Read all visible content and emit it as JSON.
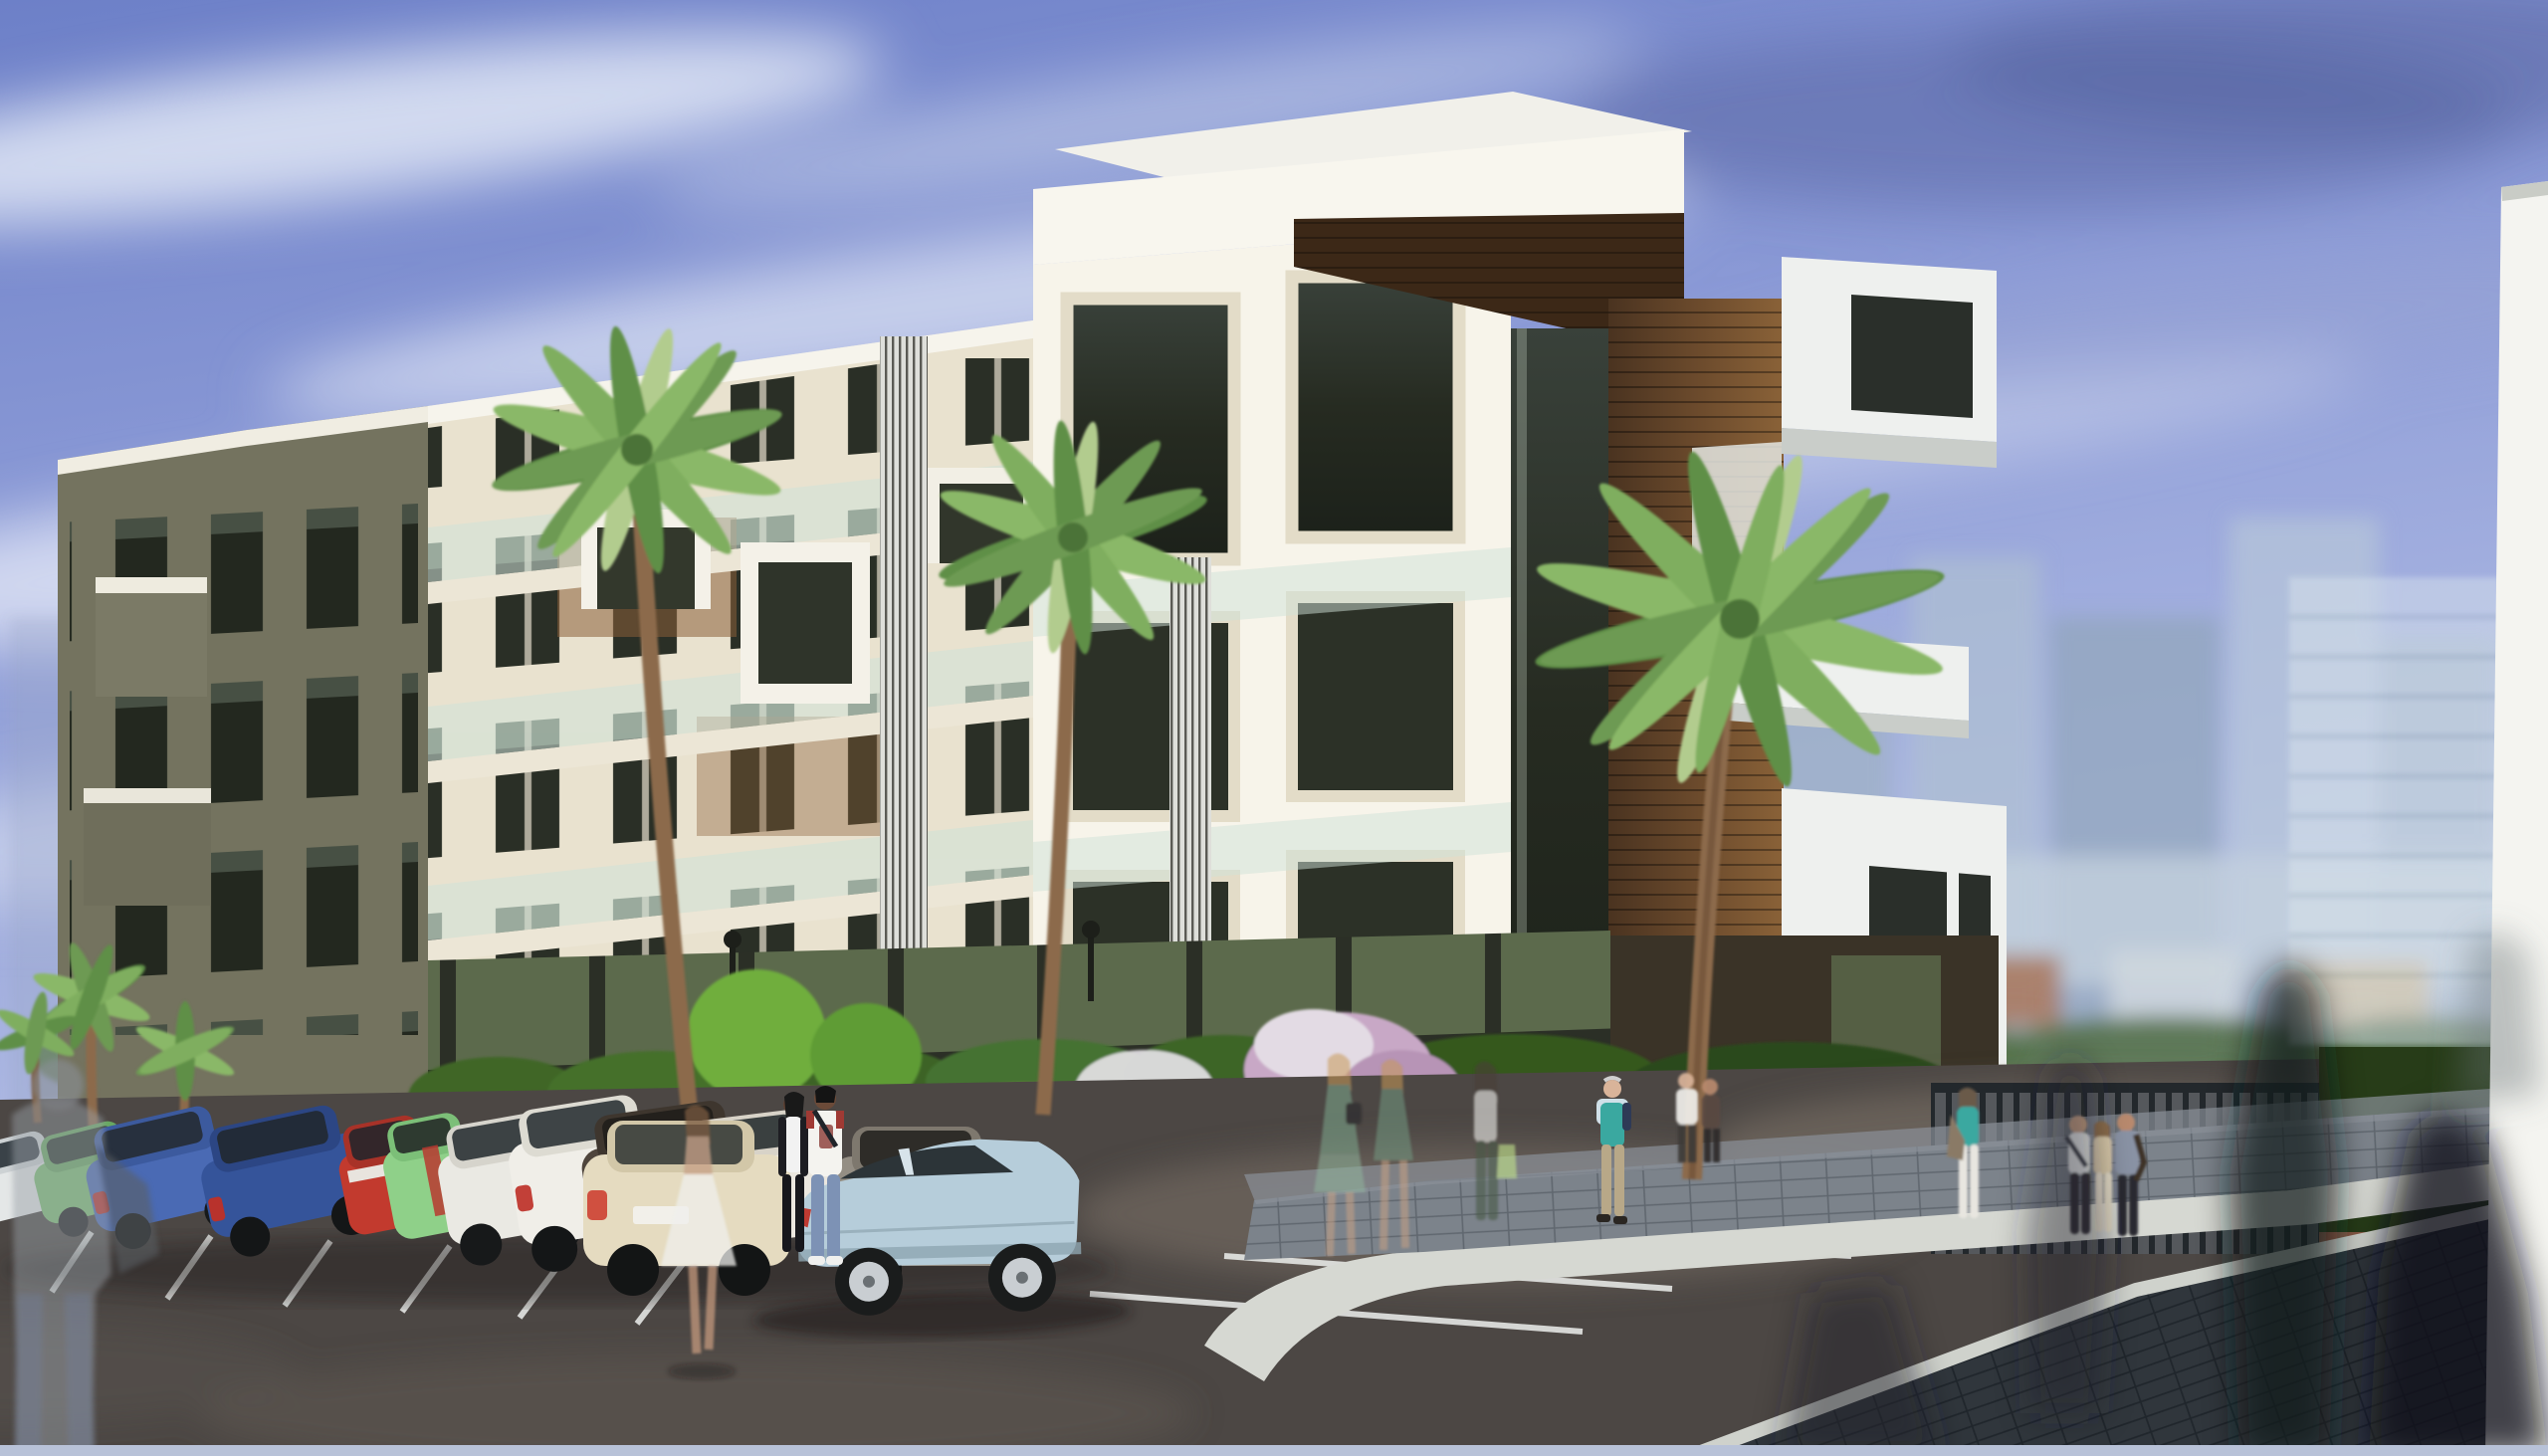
{
  "scene": {
    "title": "Architectural rendering of a modern white apartment complex with palm trees, angled street parking and pedestrians",
    "time_of_day": "daytime",
    "colors": {
      "sky_top": "#5f74bf",
      "sky_high": "#7e8fd0",
      "sky_mid": "#93a2da",
      "sky_low": "#b7c1e6",
      "sky_horizon": "#ccd3ea",
      "cloud": "#e9edf8",
      "facade_cream": "#e9e2cf",
      "facade_bright": "#f7f4ea",
      "cap_white": "#f6f4ec",
      "olive_dark": "#5b5b4a",
      "olive_mid": "#74735f",
      "wood_mid": "#6b4a2c",
      "soffit": "#3c2817",
      "glass_dark": "#262b21",
      "balustrade": "#cfe2d8",
      "louver_base": "#dedfda",
      "ground_dark": "#34382c",
      "hedge": "#3f6628",
      "hedge_dark": "#273c18",
      "shrub": "#9dc04c",
      "flower_pink": "#c8a8c6",
      "tree_green": "#6fae3e",
      "road": "#4c4744",
      "road_light": "#7b7168",
      "line_white": "#eef0ee",
      "island_paver": "#7c838b",
      "paver_dark": "#30363c",
      "curb": "#d6d8d2",
      "fence": "#2c3237",
      "pillar_white": "#f4f4f0",
      "city_tower": "#9db0c4",
      "city_warm": "#d2b488",
      "trunk": "#8c6a4c",
      "palm_green": "#5e8f46",
      "palm_light": "#8ab868",
      "bottom_strip": "#b8c2d8"
    },
    "building": {
      "floors_visible": 5,
      "style": "modern white block with stepped parapets, wood-clad corner core, floating white balcony boxes, vertical louver screens, glass balustrades"
    },
    "cars": [
      {
        "name": "white-sedan-far-left",
        "color": "#e4e7e7"
      },
      {
        "name": "green-hatchback",
        "color": "#7cc074"
      },
      {
        "name": "blue-minivan",
        "color": "#4a6ab4"
      },
      {
        "name": "dark-blue-golf",
        "color": "#35549a"
      },
      {
        "name": "red-compact",
        "color": "#c23a2e"
      },
      {
        "name": "light-green-kei-car",
        "color": "#8fd089"
      },
      {
        "name": "white-sedan",
        "color": "#eae9e3"
      },
      {
        "name": "white-crossover",
        "color": "#f0eee8"
      },
      {
        "name": "dark-gray-sedan",
        "color": "#4f453c"
      },
      {
        "name": "white-coupe-red-tails",
        "color": "#ebe7df"
      },
      {
        "name": "cream-sedan",
        "color": "#e5dbc0"
      },
      {
        "name": "gray-camaro",
        "color": "#948e84"
      },
      {
        "name": "light-blue-audi-sedan",
        "color": "#b6cdda"
      }
    ],
    "people": [
      {
        "name": "ghost-woman-white-skirt",
        "colors": {
          "skirt": "#efefec",
          "top": "#c8a288"
        }
      },
      {
        "name": "walking-woman-black-outfit",
        "colors": {
          "cardigan": "#1d1d22",
          "top": "#f2f2f2"
        }
      },
      {
        "name": "walking-man-white-tee",
        "colors": {
          "tee": "#f4f3ef",
          "jeans": "#7d92b5"
        }
      },
      {
        "name": "elderly-man-teal-vest",
        "colors": {
          "vest": "#3aa8a0",
          "pants": "#b8a888"
        }
      },
      {
        "name": "ghost-women-green-dresses",
        "colors": {
          "dress": "#7fa98f"
        }
      },
      {
        "name": "ghost-woman-shopping-bag",
        "colors": {
          "bag": "#bfe08a"
        }
      },
      {
        "name": "woman-teal-top-at-gate",
        "colors": {
          "top": "#3aa8a0",
          "pants": "#e8e6e0"
        }
      },
      {
        "name": "group-of-three-at-gate",
        "colors": {
          "shirt": "#eef0f0",
          "beige": "#d8c8a8",
          "jacket": "#8a93a5"
        }
      }
    ],
    "palm_count": 6,
    "parking": {
      "stall_line_color": "#eef0ee",
      "angle": "diagonal"
    }
  }
}
